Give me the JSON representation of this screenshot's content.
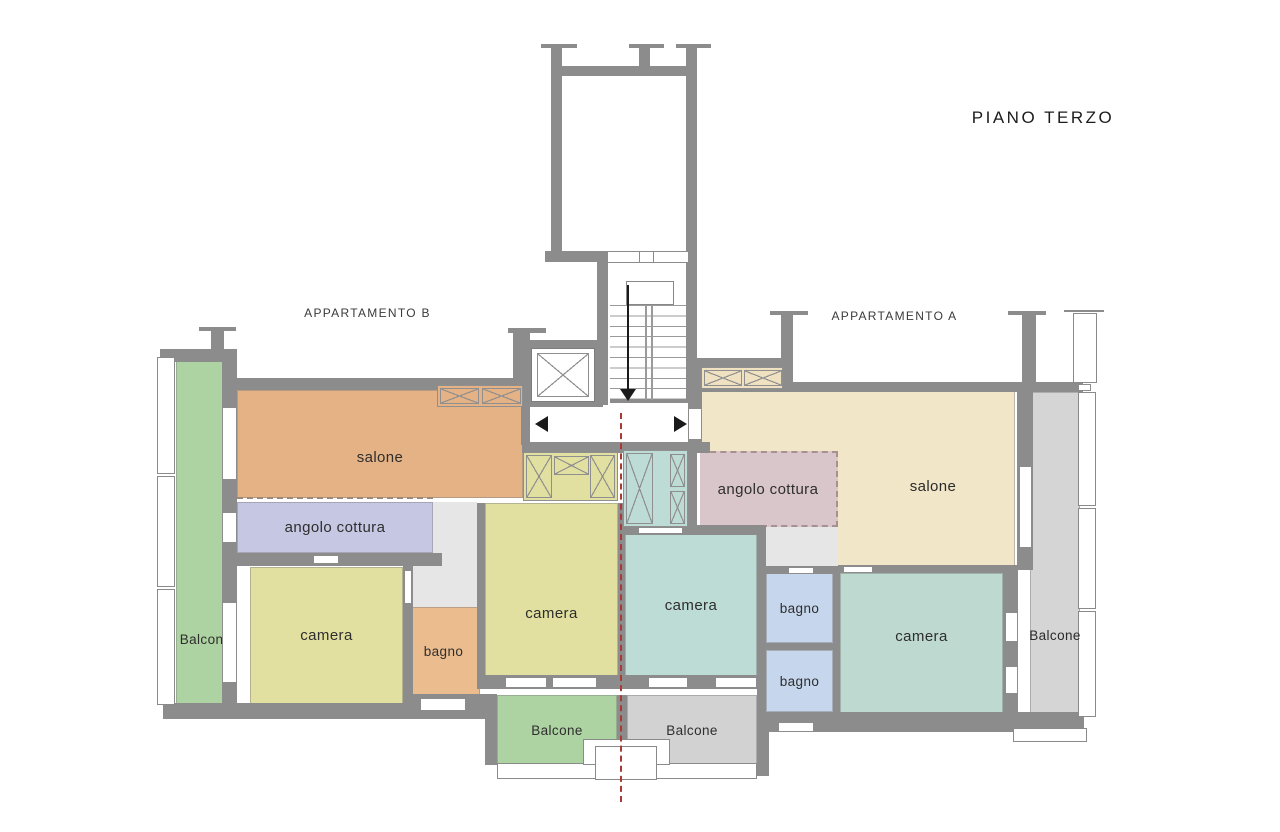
{
  "title": "PIANO TERZO",
  "apartments": {
    "b": {
      "label": "APPARTAMENTO B"
    },
    "a": {
      "label": "APPARTAMENTO A"
    }
  },
  "rooms": {
    "salone_b": "salone",
    "angolo_cottura_b": "angolo cottura",
    "camera_b1": "camera",
    "camera_b2": "camera",
    "bagno_b": "bagno",
    "balcone_b_left": "Balcone",
    "balcone_b_bottom": "Balcone",
    "salone_a": "salone",
    "angolo_cottura_a": "angolo cottura",
    "camera_a_mid": "camera",
    "camera_a": "camera",
    "bagno_a1": "bagno",
    "bagno_a2": "bagno",
    "balcone_a_right": "Balcone",
    "balcone_a_bottom": "Balcone"
  },
  "icons": {
    "corridor_left_arrow": "left-triangle",
    "corridor_right_arrow": "right-triangle",
    "stairs_down_arrow": "down-arrow",
    "elevator": "crossed-box",
    "wardrobe": "crossed-box"
  },
  "colors": {
    "wall": "#8c8c8c",
    "salone_b": "#e5b285",
    "angolo_cottura_b": "#c6c7e3",
    "camera_yellow": "#e2e0a0",
    "bagno_b": "#eabc8e",
    "balcone_green": "#aed3a2",
    "salone_a": "#f2e6c9",
    "angolo_cottura_a": "#d9c6ca",
    "camera_teal": "#bedcd6",
    "camera_a_green": "#bedad0",
    "bagno_a_blue": "#c6d6ec",
    "balcone_gray": "#d5d5d5",
    "corridor_gray": "#e6e6e6",
    "divider_line_red": "#a73a32"
  }
}
